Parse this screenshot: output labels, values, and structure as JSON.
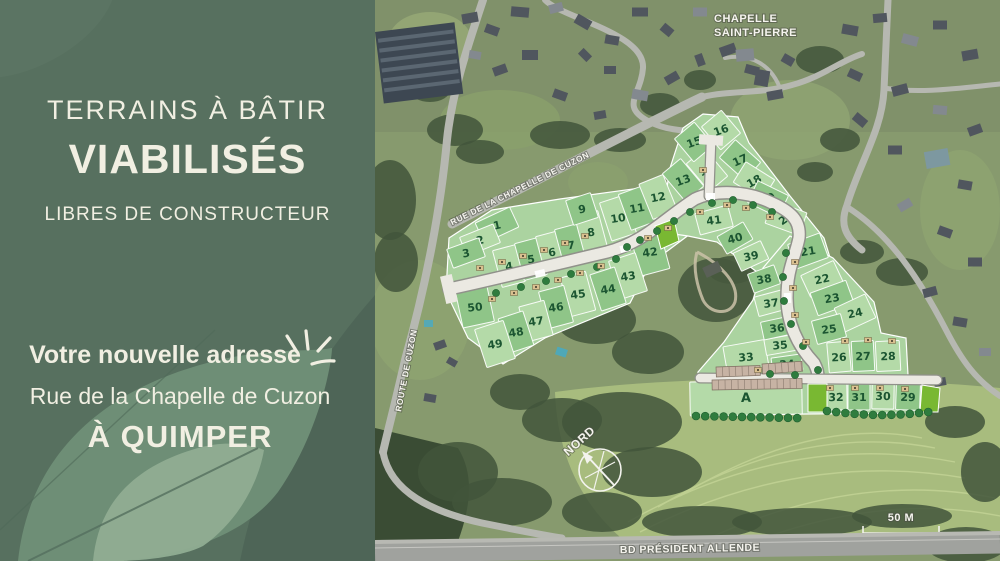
{
  "panel": {
    "title_line1": "TERRAINS À BÂTIR",
    "title_line2": "VIABILISÉS",
    "title_line3": "LIBRES DE CONSTRUCTEUR",
    "address_intro": "Votre nouvelle adresse",
    "address_street": "Rue de la Chapelle de Cuzon",
    "address_city": "À QUIMPER",
    "colors": {
      "background": "#57705f",
      "leaf_mid": "#6e8e76",
      "leaf_light": "#90ad92",
      "text": "#f1efe2"
    }
  },
  "map": {
    "colors": {
      "plot_light": "#b4daa8",
      "plot_mid": "#8fc588",
      "plot_bright": "#79b832",
      "plot_number": "#1b5531",
      "new_road": "#ebe9e2",
      "old_road": "#b6b8b1",
      "tree": "#2f7c3e",
      "field": "#a8bc7e"
    },
    "labels": [
      {
        "id": "chapelle-line1",
        "text": "CHAPELLE",
        "x": 714,
        "y": 22,
        "rot": 0,
        "size": 11,
        "anchor": "start"
      },
      {
        "id": "chapelle-line2",
        "text": "SAINT-PIERRE",
        "x": 714,
        "y": 36,
        "rot": 0,
        "size": 11,
        "anchor": "start"
      },
      {
        "id": "rue-chapelle",
        "text": "RUE DE LA CHAPELLE DE CUZON",
        "x": 521,
        "y": 191,
        "rot": -26.5,
        "size": 8.5,
        "anchor": "middle"
      },
      {
        "id": "route-cuzon",
        "text": "ROUTE DE CUZON",
        "x": 409,
        "y": 371,
        "rot": -79,
        "size": 8.5,
        "anchor": "middle"
      },
      {
        "id": "bd-allende",
        "text": "BD PRÉSIDENT ALLENDE",
        "x": 690,
        "y": 552,
        "rot": -1,
        "size": 10.5,
        "anchor": "middle"
      },
      {
        "id": "north-label",
        "text": "NORD",
        "x": 582,
        "y": 444,
        "rot": -42,
        "size": 12,
        "anchor": "middle"
      },
      {
        "id": "scale-label",
        "text": "50 M",
        "x": 901,
        "y": 521,
        "rot": 0,
        "size": 11,
        "anchor": "middle"
      }
    ],
    "plots": [
      {
        "n": "1",
        "x": 497,
        "y": 225,
        "w": 38,
        "h": 22,
        "a": -25,
        "s": "M"
      },
      {
        "n": "2",
        "x": 480,
        "y": 240,
        "w": 36,
        "h": 20,
        "a": -22,
        "s": "L"
      },
      {
        "n": "3",
        "x": 466,
        "y": 253,
        "w": 34,
        "h": 20,
        "a": -20,
        "s": "M"
      },
      {
        "n": "4",
        "x": 509,
        "y": 266,
        "w": 24,
        "h": 38,
        "a": -15,
        "s": "L"
      },
      {
        "n": "5",
        "x": 531,
        "y": 259,
        "w": 24,
        "h": 38,
        "a": -15,
        "s": "M"
      },
      {
        "n": "6",
        "x": 552,
        "y": 252,
        "w": 24,
        "h": 38,
        "a": -15,
        "s": "L"
      },
      {
        "n": "7",
        "x": 571,
        "y": 245,
        "w": 24,
        "h": 38,
        "a": -15,
        "s": "M"
      },
      {
        "n": "8",
        "x": 591,
        "y": 232,
        "w": 24,
        "h": 38,
        "a": -15,
        "s": "L"
      },
      {
        "n": "9",
        "x": 582,
        "y": 209,
        "w": 26,
        "h": 26,
        "a": -18,
        "s": "M"
      },
      {
        "n": "10",
        "x": 618,
        "y": 218,
        "w": 26,
        "h": 40,
        "a": -18,
        "s": "L"
      },
      {
        "n": "11",
        "x": 637,
        "y": 208,
        "w": 26,
        "h": 38,
        "a": -20,
        "s": "M"
      },
      {
        "n": "12",
        "x": 658,
        "y": 197,
        "w": 26,
        "h": 38,
        "a": -22,
        "s": "L"
      },
      {
        "n": "13",
        "x": 683,
        "y": 180,
        "w": 24,
        "h": 36,
        "a": -40,
        "s": "M"
      },
      {
        "n": "14",
        "x": 707,
        "y": 170,
        "w": 24,
        "h": 36,
        "a": -40,
        "s": "L"
      },
      {
        "n": "15",
        "x": 694,
        "y": 142,
        "w": 26,
        "h": 30,
        "a": -40,
        "s": "M"
      },
      {
        "n": "16",
        "x": 721,
        "y": 130,
        "w": 26,
        "h": 30,
        "a": -40,
        "s": "L"
      },
      {
        "n": "17",
        "x": 740,
        "y": 160,
        "w": 24,
        "h": 34,
        "a": -48,
        "s": "M"
      },
      {
        "n": "18",
        "x": 754,
        "y": 181,
        "w": 24,
        "h": 34,
        "a": -58,
        "s": "L"
      },
      {
        "n": "19",
        "x": 768,
        "y": 199,
        "w": 24,
        "h": 34,
        "a": -64,
        "s": "M"
      },
      {
        "n": "20",
        "x": 786,
        "y": 218,
        "w": 24,
        "h": 36,
        "a": -70,
        "s": "L"
      },
      {
        "n": "21",
        "x": 808,
        "y": 251,
        "w": 34,
        "h": 26,
        "a": -20,
        "s": "M"
      },
      {
        "n": "22",
        "x": 822,
        "y": 279,
        "w": 36,
        "h": 24,
        "a": -25,
        "s": "L"
      },
      {
        "n": "23",
        "x": 832,
        "y": 298,
        "w": 38,
        "h": 24,
        "a": -20,
        "s": "M"
      },
      {
        "n": "24",
        "x": 855,
        "y": 313,
        "w": 34,
        "h": 26,
        "a": -25,
        "s": "L"
      },
      {
        "n": "25",
        "x": 829,
        "y": 329,
        "w": 30,
        "h": 24,
        "a": -15,
        "s": "M"
      },
      {
        "n": "26",
        "x": 839,
        "y": 357,
        "w": 22,
        "h": 30,
        "a": -5,
        "s": "L"
      },
      {
        "n": "27",
        "x": 863,
        "y": 356,
        "w": 22,
        "h": 30,
        "a": -3,
        "s": "M"
      },
      {
        "n": "28",
        "x": 888,
        "y": 356,
        "w": 24,
        "h": 30,
        "a": -3,
        "s": "L"
      },
      {
        "n": "29",
        "x": 908,
        "y": 397,
        "w": 24,
        "h": 26,
        "a": 2,
        "s": "M"
      },
      {
        "n": "30",
        "x": 883,
        "y": 396,
        "w": 22,
        "h": 26,
        "a": 1,
        "s": "L"
      },
      {
        "n": "31",
        "x": 859,
        "y": 397,
        "w": 22,
        "h": 26,
        "a": 0,
        "s": "M"
      },
      {
        "n": "32",
        "x": 836,
        "y": 397,
        "w": 22,
        "h": 26,
        "a": -1,
        "s": "L"
      },
      {
        "n": "33",
        "x": 746,
        "y": 357,
        "w": 42,
        "h": 28,
        "a": -10,
        "s": "L"
      },
      {
        "n": "34",
        "x": 787,
        "y": 364,
        "w": 30,
        "h": 16,
        "a": -8,
        "s": "M"
      },
      {
        "n": "35",
        "x": 780,
        "y": 345,
        "w": 30,
        "h": 16,
        "a": -10,
        "s": "L"
      },
      {
        "n": "36",
        "x": 777,
        "y": 328,
        "w": 30,
        "h": 18,
        "a": -12,
        "s": "M"
      },
      {
        "n": "37",
        "x": 771,
        "y": 303,
        "w": 30,
        "h": 20,
        "a": -15,
        "s": "L"
      },
      {
        "n": "38",
        "x": 764,
        "y": 279,
        "w": 28,
        "h": 20,
        "a": -20,
        "s": "M"
      },
      {
        "n": "39",
        "x": 751,
        "y": 256,
        "w": 30,
        "h": 20,
        "a": -25,
        "s": "L"
      },
      {
        "n": "40",
        "x": 735,
        "y": 238,
        "w": 30,
        "h": 20,
        "a": -30,
        "s": "M"
      },
      {
        "n": "41",
        "x": 714,
        "y": 220,
        "w": 34,
        "h": 22,
        "a": -15,
        "s": "L"
      },
      {
        "n": "42",
        "x": 650,
        "y": 252,
        "w": 30,
        "h": 42,
        "a": -15,
        "s": "M"
      },
      {
        "n": "43",
        "x": 628,
        "y": 276,
        "w": 28,
        "h": 40,
        "a": -18,
        "s": "L"
      },
      {
        "n": "44",
        "x": 608,
        "y": 289,
        "w": 26,
        "h": 38,
        "a": -18,
        "s": "M"
      },
      {
        "n": "45",
        "x": 578,
        "y": 294,
        "w": 26,
        "h": 40,
        "a": -15,
        "s": "L"
      },
      {
        "n": "46",
        "x": 556,
        "y": 307,
        "w": 26,
        "h": 38,
        "a": -15,
        "s": "M"
      },
      {
        "n": "47",
        "x": 536,
        "y": 321,
        "w": 26,
        "h": 36,
        "a": -15,
        "s": "L"
      },
      {
        "n": "48",
        "x": 516,
        "y": 332,
        "w": 26,
        "h": 36,
        "a": -18,
        "s": "M"
      },
      {
        "n": "49",
        "x": 495,
        "y": 344,
        "w": 30,
        "h": 40,
        "a": -18,
        "s": "L"
      },
      {
        "n": "50",
        "x": 475,
        "y": 307,
        "w": 32,
        "h": 36,
        "a": -12,
        "s": "M"
      },
      {
        "n": "A",
        "x": 746,
        "y": 398,
        "w": 112,
        "h": 34,
        "a": -1,
        "s": "L"
      }
    ]
  }
}
